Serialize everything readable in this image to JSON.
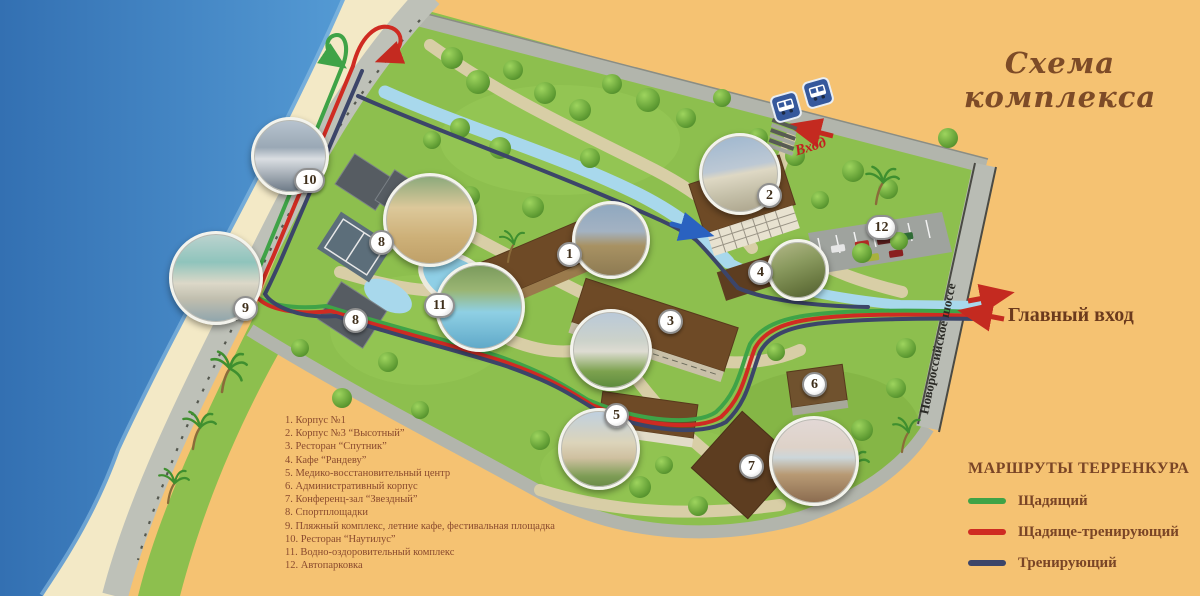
{
  "title": "Схема комплекса",
  "legend": {
    "items": [
      "1. Корпус №1",
      "2. Корпус №3 “Высотный”",
      "3. Ресторан “Спутник”",
      "4. Кафе “Рандеву”",
      "5. Медико-восстановительный центр",
      "6. Административный корпус",
      "7. Конференц-зал “Звездный”",
      "8. Спортплощадки",
      "9. Пляжный комплекс, летние кафе, фестивальная площадка",
      "10. Ресторан “Наутилус”",
      "11. Водно-оздоровительный комплекс",
      "12. Автопарковка"
    ]
  },
  "routes_legend": {
    "heading": "МАРШРУТЫ ТЕРРЕНКУРА",
    "items": [
      {
        "label": "Щадящий",
        "color": "#3fa347"
      },
      {
        "label": "Щадяще-тренирующий",
        "color": "#cf2b22"
      },
      {
        "label": "Тренирующий",
        "color": "#3c4569"
      }
    ]
  },
  "labels": {
    "entrance": "Вход",
    "main_entrance": "Главный вход",
    "road": "Новороссийское шоссе"
  },
  "badges": {
    "b1": "1",
    "b2": "2",
    "b3": "3",
    "b4": "4",
    "b5": "5",
    "b6": "6",
    "b7": "7",
    "b8": "8",
    "b9": "9",
    "b10": "10",
    "b11": "11",
    "b12": "12"
  },
  "colors": {
    "background": "#f5c272",
    "sea": "#3c7fc0",
    "beach": "#f3e9c6",
    "park": "#8dbf4e",
    "road": "#b5b8af",
    "stream": "#a8d8ec",
    "route_green": "#3fa347",
    "route_red": "#cf2b22",
    "route_blue": "#3c4569",
    "entrance_arrow_red": "#c42a20",
    "title_text": "#7d4b27",
    "legend_text": "#8a4a2e"
  }
}
